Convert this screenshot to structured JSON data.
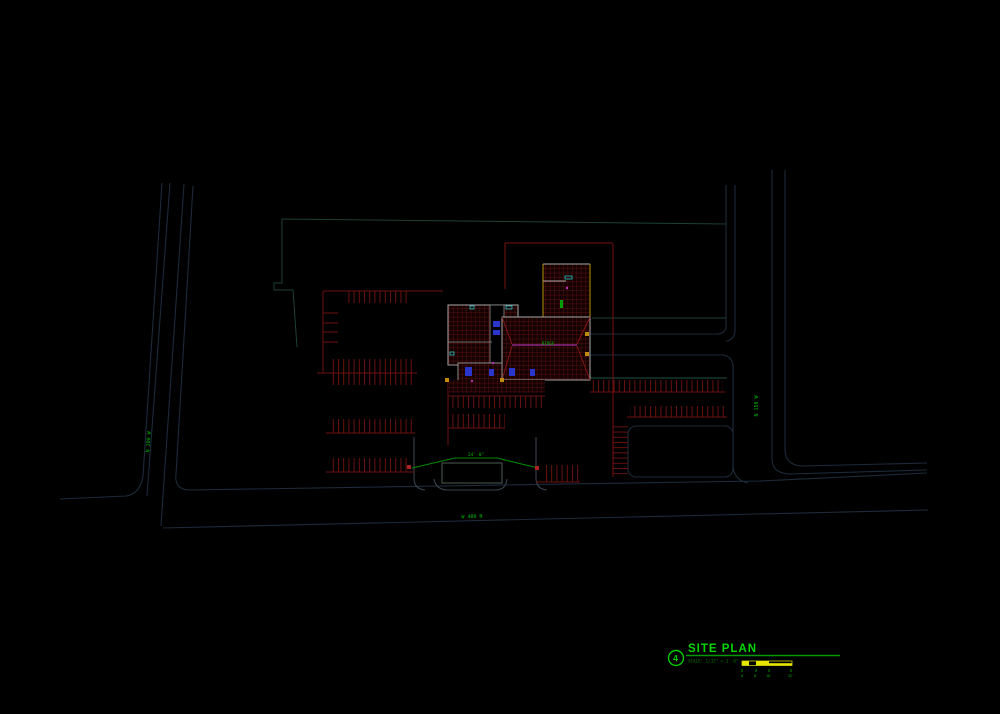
{
  "drawing": {
    "title_block": {
      "detail_number": "4",
      "title": "SITE PLAN",
      "scale_note": "SCALE: 1/32\" = 1'-0\""
    },
    "scale_bar": {
      "tick_labels": [
        "0",
        "8'",
        "16'",
        "32'"
      ]
    },
    "street_labels": {
      "west_road": "N 200 W",
      "east_road": "N 150 W",
      "south_street": "W 400 N"
    },
    "annotations": {
      "driveway_dim": "24'-0\"",
      "ridge_label": "RIDGE"
    },
    "colors": {
      "background": "#000000",
      "road_line": "#1c2a3a",
      "curb_gray": "#39434f",
      "boundary_teal": "#1d4034",
      "parking_red": "#6b1111",
      "roof_hatch_red": "#701111",
      "boundary_red": "#7a1010",
      "wall_gray": "#a8a8a8",
      "accent_cyan": "#22c4c4",
      "accent_blue": "#2a35cc",
      "accent_magenta": "#c23ac2",
      "marker_yellow": "#c08a10",
      "scalebar_yellow": "#e6e600",
      "annotation_green": "#00b400",
      "title_green": "#00d800"
    }
  }
}
